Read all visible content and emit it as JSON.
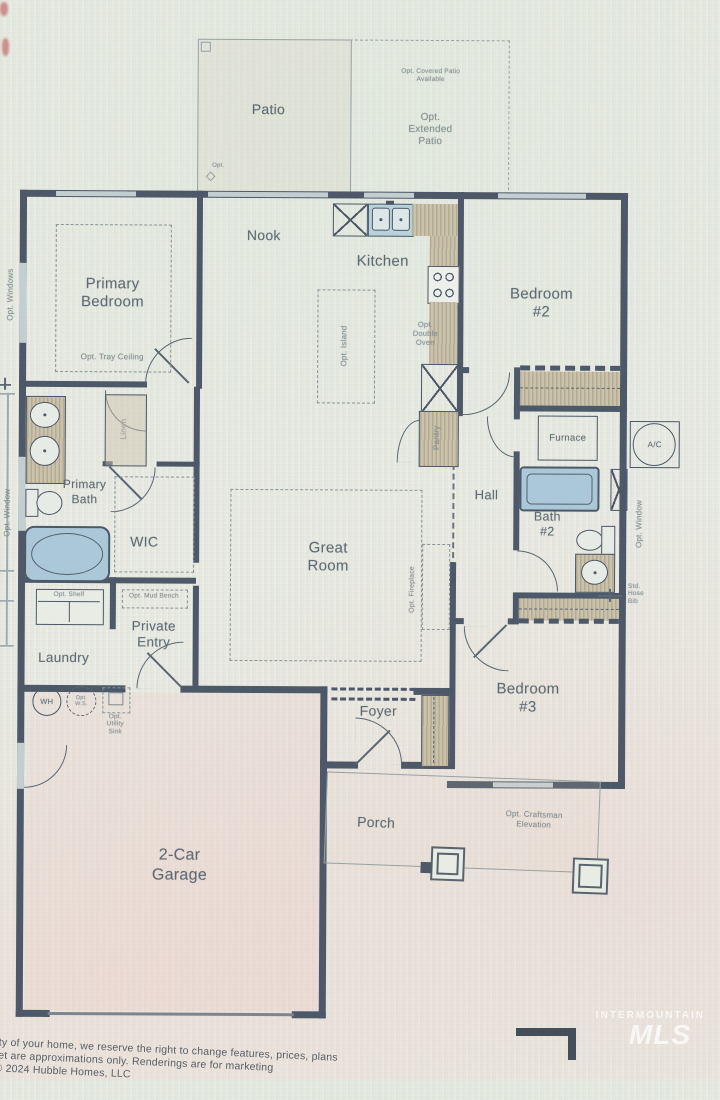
{
  "labels": {
    "patio": "Patio",
    "opt_covered_patio": "Opt. Covered Patio\nAvailable",
    "opt_extended_patio": "Opt.\nExtended\nPatio",
    "patio_corner_note": "Opt.",
    "nook": "Nook",
    "kitchen": "Kitchen",
    "opt_double_oven": "Opt.\nDouble\nOven",
    "opt_island": "Opt. Island",
    "pantry": "Pantry",
    "primary_bedroom": "Primary\nBedroom",
    "opt_tray_ceiling": "Opt. Tray Ceiling",
    "opt_windows": "Opt. Windows",
    "opt_window_left": "Opt. Window",
    "primary_bath": "Primary\nBath",
    "linen": "Linen",
    "wic": "WIC",
    "bedroom2": "Bedroom\n#2",
    "furnace": "Furnace",
    "ac": "A/C",
    "hall": "Hall",
    "bath2": "Bath\n#2",
    "opt_window_right": "Opt. Window",
    "std_hose_bib": "Std.\nHose\nBib",
    "great_room": "Great\nRoom",
    "opt_fireplace": "Opt. Fireplace",
    "opt_shelf": "Opt. Shelf",
    "opt_mud_bench": "Opt. Mud Bench",
    "laundry": "Laundry",
    "private_entry": "Private\nEntry",
    "wh": "WH",
    "opt_ws": "Opt.\nW.S.",
    "opt_utility_sink": "Opt.\nUtility\nSink",
    "garage": "2-Car\nGarage",
    "foyer": "Foyer",
    "bedroom3": "Bedroom\n#3",
    "porch": "Porch",
    "opt_craftsman": "Opt. Craftsman\nElevation"
  },
  "footer": {
    "line1": "lity of your home, we reserve the right to change features, prices, plans",
    "line2": "feet are approximations only. Renderings are for marketing",
    "line3": "© 2024 Hubble Homes, LLC"
  },
  "watermark": {
    "line1": "INTERMOUNTAIN",
    "line2": "MLS"
  },
  "colors": {
    "wall": "#4d5868",
    "label": "#5f6b74",
    "tub": "#abc8d8",
    "counter": "#cbc2ab",
    "window": "#c3ced1"
  }
}
